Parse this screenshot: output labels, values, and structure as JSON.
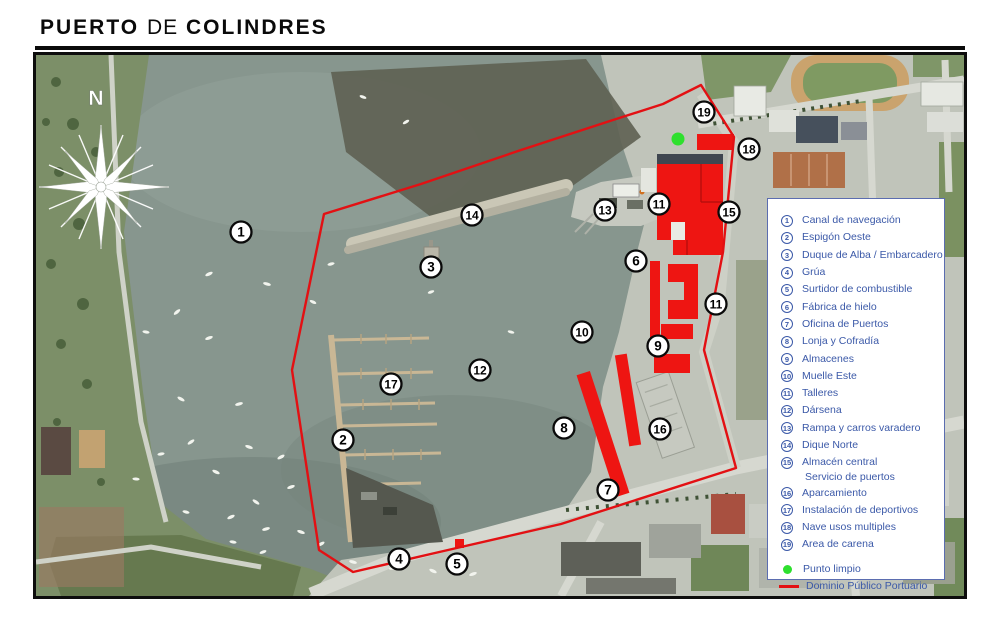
{
  "title": {
    "part1": "PUERTO",
    "part2": "DE",
    "part3": "COLINDRES"
  },
  "colors": {
    "boundary_red": "#e31013",
    "building_red": "#ee1512",
    "green_dot": "#2ee02e",
    "legend_blue": "#3b59a8",
    "water": "#87968e"
  },
  "legend": {
    "items": [
      {
        "num": "1",
        "label": "Canal de navegación"
      },
      {
        "num": "2",
        "label": "Espigón Oeste"
      },
      {
        "num": "3",
        "label": "Duque de Alba / Embarcadero"
      },
      {
        "num": "4",
        "label": "Grúa"
      },
      {
        "num": "5",
        "label": "Surtidor de combustible"
      },
      {
        "num": "6",
        "label": "Fábrica de hielo"
      },
      {
        "num": "7",
        "label": "Oficina de Puertos"
      },
      {
        "num": "8",
        "label": "Lonja y Cofradía"
      },
      {
        "num": "9",
        "label": "Almacenes"
      },
      {
        "num": "10",
        "label": "Muelle Este"
      },
      {
        "num": "11",
        "label": "Talleres"
      },
      {
        "num": "12",
        "label": "Dársena"
      },
      {
        "num": "13",
        "label": "Rampa y carros varadero"
      },
      {
        "num": "14",
        "label": "Dique Norte"
      },
      {
        "num": "15",
        "label": "Almacén central",
        "label2": "Servicio de puertos"
      },
      {
        "num": "16",
        "label": "Aparcamiento"
      },
      {
        "num": "17",
        "label": "Instalación de deportivos"
      },
      {
        "num": "18",
        "label": "Nave usos multiples"
      },
      {
        "num": "19",
        "label": "Area de carena"
      }
    ],
    "punto_limpio_label": "Punto limpio",
    "dominio_label": "Dominio Público Portuario"
  },
  "map": {
    "compass_label": "N",
    "punto_limpio": {
      "x": 677,
      "y": 137
    },
    "markers": [
      {
        "n": "1",
        "x": 240,
        "y": 230
      },
      {
        "n": "14",
        "x": 471,
        "y": 213
      },
      {
        "n": "3",
        "x": 430,
        "y": 265
      },
      {
        "n": "13",
        "x": 604,
        "y": 208
      },
      {
        "n": "11",
        "x": 658,
        "y": 202
      },
      {
        "n": "15",
        "x": 728,
        "y": 210
      },
      {
        "n": "19",
        "x": 703,
        "y": 110
      },
      {
        "n": "18",
        "x": 748,
        "y": 147
      },
      {
        "n": "6",
        "x": 635,
        "y": 259
      },
      {
        "n": "11",
        "x": 715,
        "y": 302
      },
      {
        "n": "10",
        "x": 581,
        "y": 330
      },
      {
        "n": "9",
        "x": 657,
        "y": 344
      },
      {
        "n": "12",
        "x": 479,
        "y": 368
      },
      {
        "n": "17",
        "x": 390,
        "y": 382
      },
      {
        "n": "2",
        "x": 342,
        "y": 438
      },
      {
        "n": "8",
        "x": 563,
        "y": 426
      },
      {
        "n": "16",
        "x": 659,
        "y": 427
      },
      {
        "n": "7",
        "x": 607,
        "y": 488
      },
      {
        "n": "4",
        "x": 398,
        "y": 557
      },
      {
        "n": "5",
        "x": 456,
        "y": 562
      }
    ]
  }
}
